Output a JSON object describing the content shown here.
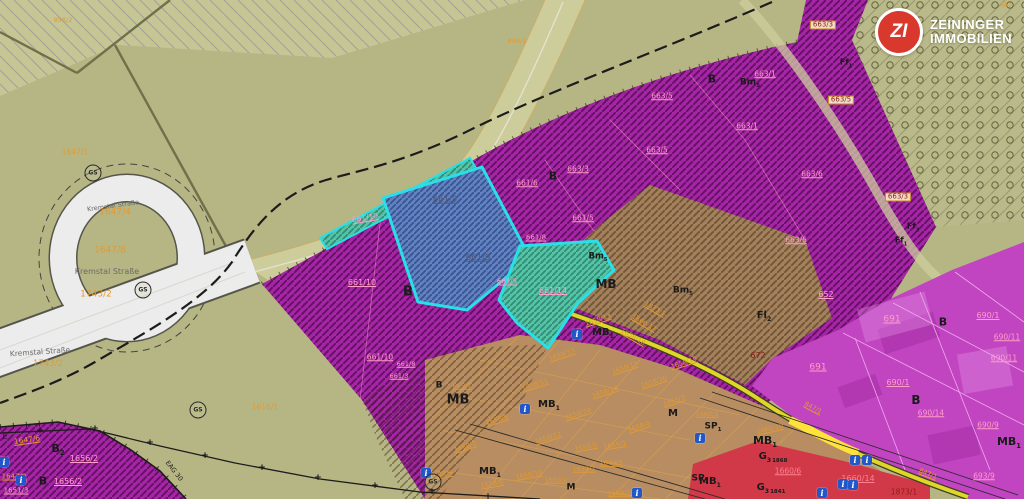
{
  "logo": {
    "monogram": "ZI",
    "line1": "ZEININGER",
    "line2": "IMMOBILIEN"
  },
  "map": {
    "colors": {
      "olive_background": "#b6b685",
      "purple_zone": "#a625a6",
      "magenta_zone": "#c145c1",
      "brown_zone": "#a3815c",
      "tan_grid_zone": "#b78d61",
      "red_zone": "#d23948",
      "blue_parcel": "#6082c2",
      "teal_parcel": "#55c3a5",
      "highlight_border": "#29dfe8",
      "road_white": "#ececec",
      "road_yellow": "#ded629",
      "parcel_number_orange": "#e09a35",
      "parcel_number_pink": "#ff9ec8",
      "logo_red": "#d8392c"
    },
    "labels": [
      {
        "t": "858/2",
        "x": 63,
        "y": 20,
        "c": "o",
        "s": 6.5
      },
      {
        "t": "864/1",
        "x": 517,
        "y": 41,
        "c": "o",
        "s": 6.5
      },
      {
        "t": "667",
        "x": 1006,
        "y": 6,
        "c": "o",
        "s": 6
      },
      {
        "t": "1647/1",
        "x": 75,
        "y": 152,
        "c": "o",
        "s": 7.5
      },
      {
        "t": "Kremstal Straße",
        "x": 113,
        "y": 206,
        "c": "g",
        "s": 6.5,
        "r": -8,
        "n": "street-label"
      },
      {
        "t": "1647/4",
        "x": 115,
        "y": 213,
        "c": "o",
        "s": 9
      },
      {
        "t": "1647/8",
        "x": 110,
        "y": 251,
        "c": "o",
        "s": 9
      },
      {
        "t": "Kremstal Straße",
        "x": 107,
        "y": 272,
        "c": "g",
        "s": 8,
        "n": "street-label"
      },
      {
        "t": "1743/2",
        "x": 96,
        "y": 295,
        "c": "o",
        "s": 9
      },
      {
        "t": "Kremstal Straße",
        "x": 40,
        "y": 352,
        "c": "g",
        "s": 7.5,
        "r": -4,
        "n": "street-label"
      },
      {
        "t": "1743/2",
        "x": 48,
        "y": 364,
        "c": "o",
        "s": 8.5
      },
      {
        "t": "1616/1",
        "x": 265,
        "y": 407,
        "c": "o",
        "s": 7.5
      },
      {
        "t": "E",
        "x": 5,
        "y": 437,
        "c": "k",
        "s": 8
      },
      {
        "t": "1647/6",
        "x": 27,
        "y": 440,
        "c": "o",
        "s": 7.5,
        "r": -8,
        "u": 1
      },
      {
        "t": "B",
        "sub": "2",
        "x": 58,
        "y": 450,
        "c": "k",
        "s": 11,
        "b": 1
      },
      {
        "t": "1656/2",
        "x": 84,
        "y": 459,
        "c": "p",
        "s": 8,
        "u": 1
      },
      {
        "t": "1647/9",
        "x": 14,
        "y": 477,
        "c": "o",
        "s": 7,
        "u": 1
      },
      {
        "t": "B",
        "x": 43,
        "y": 481,
        "c": "k",
        "s": 11,
        "b": 1
      },
      {
        "t": "1656/2",
        "x": 68,
        "y": 482,
        "c": "p",
        "s": 8,
        "u": 1
      },
      {
        "t": "1651/3",
        "x": 16,
        "y": 491,
        "c": "p",
        "s": 7,
        "u": 1
      },
      {
        "t": "EAG 30",
        "x": 174,
        "y": 471,
        "c": "k",
        "s": 6.5,
        "r": 52
      },
      {
        "t": "661/10",
        "x": 365,
        "y": 218,
        "c": "p",
        "s": 7.5,
        "r": -10,
        "u": 1
      },
      {
        "t": "661/10",
        "x": 362,
        "y": 283,
        "c": "p",
        "s": 8,
        "u": 1
      },
      {
        "t": "661/10",
        "x": 380,
        "y": 357,
        "c": "p",
        "s": 7.5,
        "u": 1
      },
      {
        "t": "B",
        "x": 408,
        "y": 292,
        "c": "k",
        "s": 13,
        "b": 1
      },
      {
        "t": "B",
        "x": 553,
        "y": 176,
        "c": "k",
        "s": 11,
        "b": 1
      },
      {
        "t": "661/6",
        "x": 527,
        "y": 183,
        "c": "p",
        "s": 7.5,
        "u": 1
      },
      {
        "t": "663/3",
        "x": 578,
        "y": 169,
        "c": "p",
        "s": 7.5,
        "u": 1
      },
      {
        "t": "661/5",
        "x": 583,
        "y": 218,
        "c": "p",
        "s": 7.5,
        "u": 1
      },
      {
        "t": "661/8",
        "x": 536,
        "y": 238,
        "c": "p",
        "s": 7,
        "u": 1
      },
      {
        "t": "661/5",
        "x": 507,
        "y": 282,
        "c": "p",
        "s": 7,
        "u": 1
      },
      {
        "t": "661/9",
        "x": 445,
        "y": 200,
        "c": "s",
        "s": 8.5,
        "u": 1
      },
      {
        "t": "661/9",
        "x": 478,
        "y": 258,
        "c": "s",
        "s": 8.5,
        "u": 1
      },
      {
        "t": "661/14",
        "x": 553,
        "y": 291,
        "c": "p",
        "s": 8,
        "u": 1
      },
      {
        "t": "661/8",
        "x": 406,
        "y": 364,
        "c": "p",
        "s": 6.5,
        "u": 1
      },
      {
        "t": "661/3",
        "x": 399,
        "y": 376,
        "c": "p",
        "s": 6.5,
        "u": 1
      },
      {
        "t": "663/5",
        "x": 662,
        "y": 96,
        "c": "p",
        "s": 7.5,
        "u": 1
      },
      {
        "t": "663/5",
        "x": 657,
        "y": 150,
        "c": "p",
        "s": 7.5,
        "u": 1
      },
      {
        "t": "663/1",
        "x": 765,
        "y": 74,
        "c": "p",
        "s": 7.5,
        "u": 1
      },
      {
        "t": "663/1",
        "x": 747,
        "y": 126,
        "c": "p",
        "s": 7.5,
        "u": 1
      },
      {
        "t": "B",
        "x": 712,
        "y": 79,
        "c": "k",
        "s": 11,
        "b": 1
      },
      {
        "t": "Bm",
        "sub": "5",
        "x": 750,
        "y": 84,
        "c": "k",
        "s": 9,
        "b": 1
      },
      {
        "t": "663/6",
        "x": 812,
        "y": 174,
        "c": "p",
        "s": 7.5,
        "u": 1
      },
      {
        "t": "663/6",
        "x": 796,
        "y": 240,
        "c": "p",
        "s": 7.5,
        "u": 1
      },
      {
        "t": "652",
        "x": 826,
        "y": 295,
        "c": "p",
        "s": 8,
        "u": 1
      },
      {
        "t": "663/3",
        "x": 823,
        "y": 25,
        "c": "d",
        "s": 7,
        "bx": 1
      },
      {
        "t": "663/5",
        "x": 841,
        "y": 100,
        "c": "d",
        "s": 7,
        "bx": 1
      },
      {
        "t": "663/3",
        "x": 898,
        "y": 197,
        "c": "d",
        "s": 7,
        "bx": 1
      },
      {
        "t": "Ff",
        "sub": "1",
        "x": 846,
        "y": 64,
        "c": "k",
        "s": 8,
        "b": 1
      },
      {
        "t": "Ff",
        "sub": "2",
        "x": 913,
        "y": 228,
        "c": "k",
        "s": 8,
        "b": 1
      },
      {
        "t": "Ff",
        "sub": "1",
        "x": 901,
        "y": 242,
        "c": "k",
        "s": 8,
        "b": 1
      },
      {
        "t": "MB",
        "x": 606,
        "y": 284,
        "c": "k",
        "s": 12,
        "b": 1
      },
      {
        "t": "Bm",
        "sub": "5",
        "x": 598,
        "y": 258,
        "c": "k",
        "s": 8.5,
        "b": 1
      },
      {
        "t": "Bm",
        "sub": "5",
        "x": 683,
        "y": 292,
        "c": "k",
        "s": 9,
        "b": 1
      },
      {
        "t": "Fl",
        "sub": "2",
        "x": 764,
        "y": 317,
        "c": "k",
        "s": 10,
        "b": 1
      },
      {
        "t": "672",
        "x": 758,
        "y": 356,
        "c": "d",
        "s": 8
      },
      {
        "t": "1873/1",
        "x": 655,
        "y": 309,
        "c": "o",
        "s": 6.5,
        "r": 30,
        "u": 1
      },
      {
        "t": "1660/17",
        "x": 644,
        "y": 323,
        "c": "o",
        "s": 6.5,
        "r": 30,
        "u": 1
      },
      {
        "t": "1658/18",
        "x": 633,
        "y": 337,
        "c": "o",
        "s": 6.5,
        "r": 30,
        "u": 1
      },
      {
        "t": "691",
        "x": 892,
        "y": 320,
        "c": "p",
        "s": 9,
        "u": 1
      },
      {
        "t": "B",
        "x": 943,
        "y": 322,
        "c": "k",
        "s": 11,
        "b": 1
      },
      {
        "t": "690/1",
        "x": 988,
        "y": 316,
        "c": "p",
        "s": 8,
        "u": 1
      },
      {
        "t": "690/11",
        "x": 1007,
        "y": 337,
        "c": "p",
        "s": 7.5,
        "u": 1
      },
      {
        "t": "690/11",
        "x": 1004,
        "y": 358,
        "c": "p",
        "s": 7.5,
        "u": 1
      },
      {
        "t": "691",
        "x": 818,
        "y": 368,
        "c": "p",
        "s": 9,
        "u": 1
      },
      {
        "t": "690/1",
        "x": 898,
        "y": 383,
        "c": "p",
        "s": 8,
        "u": 1
      },
      {
        "t": "B",
        "x": 916,
        "y": 400,
        "c": "k",
        "s": 12,
        "b": 1
      },
      {
        "t": "690/14",
        "x": 931,
        "y": 413,
        "c": "p",
        "s": 7.5,
        "u": 1
      },
      {
        "t": "690/9",
        "x": 988,
        "y": 425,
        "c": "p",
        "s": 7.5,
        "u": 1
      },
      {
        "t": "693/9",
        "x": 984,
        "y": 476,
        "c": "p",
        "s": 7.5,
        "u": 1
      },
      {
        "t": "847/1",
        "x": 813,
        "y": 408,
        "c": "o",
        "s": 6.5,
        "r": 28,
        "u": 1
      },
      {
        "t": "847/1",
        "x": 928,
        "y": 474,
        "c": "o",
        "s": 6.5,
        "r": 22,
        "u": 1
      },
      {
        "t": "1873/1",
        "x": 904,
        "y": 492,
        "c": "d",
        "s": 7.5
      },
      {
        "t": "1658/13",
        "x": 598,
        "y": 320,
        "c": "o",
        "s": 6.5,
        "r": -18,
        "u": 1
      },
      {
        "t": "1658/13",
        "x": 562,
        "y": 355,
        "c": "o",
        "s": 6.5,
        "r": -18,
        "u": 1
      },
      {
        "t": "MB",
        "sub": "1",
        "x": 603,
        "y": 334,
        "c": "k",
        "s": 10,
        "b": 1
      },
      {
        "t": "1658/11",
        "x": 535,
        "y": 385,
        "c": "o",
        "s": 6.5,
        "r": -18,
        "u": 1
      },
      {
        "t": "1658/17",
        "x": 625,
        "y": 368,
        "c": "o",
        "s": 6.5,
        "r": -18,
        "u": 1
      },
      {
        "t": "1658/16",
        "x": 605,
        "y": 392,
        "c": "o",
        "s": 6.5,
        "r": -18,
        "u": 1
      },
      {
        "t": "1658/19",
        "x": 684,
        "y": 363,
        "c": "o",
        "s": 6.5,
        "r": -18,
        "u": 1
      },
      {
        "t": "1658/20",
        "x": 654,
        "y": 382,
        "c": "o",
        "s": 6.5,
        "r": -18,
        "u": 1
      },
      {
        "t": "1655/3",
        "x": 674,
        "y": 401,
        "c": "o",
        "s": 6.5,
        "r": -18,
        "u": 1
      },
      {
        "t": "M",
        "x": 673,
        "y": 414,
        "c": "k",
        "s": 10,
        "b": 1
      },
      {
        "t": "1658/9",
        "x": 497,
        "y": 420,
        "c": "o",
        "s": 6.5,
        "r": -18,
        "u": 1
      },
      {
        "t": "1658/14",
        "x": 578,
        "y": 414,
        "c": "o",
        "s": 6.5,
        "r": -18,
        "u": 1
      },
      {
        "t": "1658/4",
        "x": 639,
        "y": 427,
        "c": "o",
        "s": 6.5,
        "r": -18,
        "u": 1
      },
      {
        "t": "MB",
        "sub": "1",
        "x": 549,
        "y": 406,
        "c": "k",
        "s": 10,
        "b": 1
      },
      {
        "t": "1658/7",
        "x": 465,
        "y": 447,
        "c": "o",
        "s": 6.5,
        "r": -18,
        "u": 1
      },
      {
        "t": "1658/12",
        "x": 548,
        "y": 438,
        "c": "o",
        "s": 6.5,
        "r": -18,
        "u": 1
      },
      {
        "t": "1655/5",
        "x": 586,
        "y": 447,
        "c": "o",
        "s": 6.5,
        "r": -10,
        "u": 1
      },
      {
        "t": "1659/1",
        "x": 615,
        "y": 445,
        "c": "o",
        "s": 6.5,
        "r": -10,
        "u": 1
      },
      {
        "t": "1658/5",
        "x": 441,
        "y": 475,
        "c": "o",
        "s": 6.5,
        "r": -10,
        "u": 1
      },
      {
        "t": "MB",
        "sub": "1",
        "x": 490,
        "y": 473,
        "c": "k",
        "s": 10,
        "b": 1
      },
      {
        "t": "1658/10",
        "x": 529,
        "y": 475,
        "c": "o",
        "s": 6.5,
        "r": -10,
        "u": 1
      },
      {
        "t": "1658/8",
        "x": 492,
        "y": 484,
        "c": "o",
        "s": 6.5,
        "r": -10,
        "u": 1
      },
      {
        "t": "1659/7",
        "x": 584,
        "y": 469,
        "c": "o",
        "s": 6.5,
        "u": 1
      },
      {
        "t": "1659/2",
        "x": 556,
        "y": 480,
        "c": "o",
        "s": 6.5,
        "u": 1
      },
      {
        "t": "M",
        "x": 571,
        "y": 488,
        "c": "k",
        "s": 9,
        "b": 1
      },
      {
        "t": "1640/3",
        "x": 611,
        "y": 463,
        "c": "o",
        "s": 6.5,
        "u": 1
      },
      {
        "t": "1659/3",
        "x": 619,
        "y": 493,
        "c": "o",
        "s": 6.5,
        "u": 1
      },
      {
        "t": "SP",
        "sub": "1",
        "x": 713,
        "y": 428,
        "c": "k",
        "s": 9,
        "b": 1
      },
      {
        "t": "SP",
        "sub": "1",
        "x": 700,
        "y": 480,
        "c": "k",
        "s": 9,
        "b": 1
      },
      {
        "t": "MB",
        "sub": "1",
        "x": 765,
        "y": 442,
        "c": "k",
        "s": 11,
        "b": 1
      },
      {
        "t": "MB",
        "sub": "1",
        "x": 710,
        "y": 483,
        "c": "k",
        "s": 10,
        "b": 1
      },
      {
        "t": "MB",
        "sub": "1",
        "x": 1009,
        "y": 443,
        "c": "k",
        "s": 11,
        "b": 1
      },
      {
        "t": "G",
        "sub": "3",
        "tail": "1868",
        "x": 773,
        "y": 458,
        "c": "k",
        "s": 10,
        "b": 1
      },
      {
        "t": "G",
        "sub": "3",
        "tail": "1841",
        "x": 771,
        "y": 489,
        "c": "k",
        "s": 10,
        "b": 1
      },
      {
        "t": "1660/10",
        "x": 770,
        "y": 429,
        "c": "o",
        "s": 6.5,
        "r": -12,
        "u": 1
      },
      {
        "t": "1660/3",
        "x": 707,
        "y": 414,
        "c": "o",
        "s": 6.5,
        "u": 1
      },
      {
        "t": "1660/6",
        "x": 788,
        "y": 471,
        "c": "rp",
        "s": 7.5,
        "u": 1
      },
      {
        "t": "1660/14",
        "x": 858,
        "y": 479,
        "c": "rp",
        "s": 8,
        "u": 1
      },
      {
        "t": "B",
        "x": 439,
        "y": 386,
        "c": "k",
        "s": 9,
        "b": 1
      },
      {
        "t": "665/7",
        "x": 462,
        "y": 386,
        "c": "o",
        "s": 6.5,
        "u": 1
      },
      {
        "t": "MB",
        "x": 458,
        "y": 400,
        "c": "k",
        "s": 13,
        "b": 1
      }
    ],
    "info_icons": [
      {
        "x": 577,
        "y": 334
      },
      {
        "x": 525,
        "y": 409
      },
      {
        "x": 426,
        "y": 473
      },
      {
        "x": 700,
        "y": 438
      },
      {
        "x": 855,
        "y": 460
      },
      {
        "x": 867,
        "y": 460
      },
      {
        "x": 843,
        "y": 484
      },
      {
        "x": 853,
        "y": 485
      },
      {
        "x": 4,
        "y": 462
      },
      {
        "x": 21,
        "y": 480
      },
      {
        "x": 637,
        "y": 493
      },
      {
        "x": 822,
        "y": 493
      }
    ],
    "gs_markers": [
      {
        "t": "GS",
        "x": 93,
        "y": 173
      },
      {
        "t": "GS",
        "x": 143,
        "y": 290
      },
      {
        "t": "GS",
        "x": 198,
        "y": 410
      },
      {
        "t": "GS",
        "x": 433,
        "y": 482
      }
    ],
    "plus_marks": [
      {
        "x": 40,
        "y": 431
      },
      {
        "x": 95,
        "y": 429
      },
      {
        "x": 150,
        "y": 443
      },
      {
        "x": 205,
        "y": 456
      },
      {
        "x": 262,
        "y": 468
      },
      {
        "x": 318,
        "y": 478
      },
      {
        "x": 375,
        "y": 486
      },
      {
        "x": 432,
        "y": 492
      },
      {
        "x": 488,
        "y": 497
      }
    ]
  }
}
